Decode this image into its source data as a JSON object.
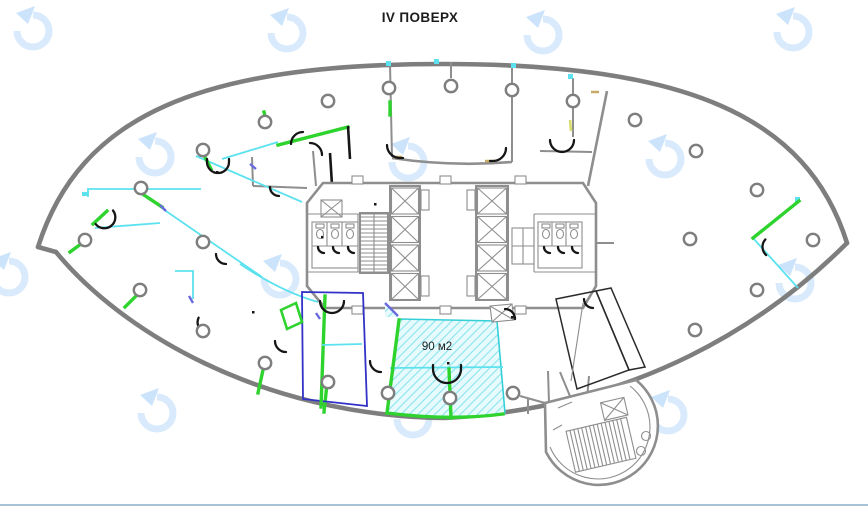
{
  "title": {
    "text": "IV ПОВЕРХ"
  },
  "plan": {
    "area_label": "90 м2",
    "colors": {
      "outer_wall": "#7e7e7e",
      "core": "#8e8e8e",
      "column_gray": "#7e7e7e",
      "partition_cyan": "#5ce2ef",
      "accent_green": "#2ed32e",
      "room_blue": "#3232c8",
      "door_black": "#161616",
      "tick_violet": "#6a6ae0",
      "tick_tan": "#c9aa66",
      "tick_yellow": "#d8de6e",
      "highlight_fill": "#e7fbfd",
      "highlight_hatch": "#8fe4ee",
      "highlight_border": "#35cfd8",
      "watermark": "#d8eafc",
      "watermark_arrow": "#cbe3fb",
      "divider": "#a9c3d6"
    },
    "watermarks": [
      [
        8,
        4
      ],
      [
        262,
        6
      ],
      [
        518,
        8
      ],
      [
        768,
        5
      ],
      [
        130,
        130
      ],
      [
        383,
        135
      ],
      [
        640,
        132
      ],
      [
        -16,
        250
      ],
      [
        255,
        252
      ],
      [
        530,
        251
      ],
      [
        770,
        256
      ],
      [
        132,
        386
      ],
      [
        388,
        392
      ],
      [
        643,
        388
      ]
    ],
    "columns": [
      [
        141,
        188
      ],
      [
        203,
        150
      ],
      [
        265,
        122
      ],
      [
        328,
        101
      ],
      [
        389,
        88
      ],
      [
        451,
        86
      ],
      [
        512,
        90
      ],
      [
        573,
        101
      ],
      [
        635,
        120
      ],
      [
        696,
        151
      ],
      [
        757,
        190
      ],
      [
        813,
        240
      ],
      [
        757,
        290
      ],
      [
        695,
        330
      ],
      [
        690,
        239
      ],
      [
        85,
        240
      ],
      [
        203,
        242
      ],
      [
        140,
        290
      ],
      [
        203,
        331
      ],
      [
        265,
        363
      ],
      [
        328,
        382
      ],
      [
        388,
        393
      ],
      [
        450,
        398
      ],
      [
        513,
        393
      ]
    ]
  }
}
